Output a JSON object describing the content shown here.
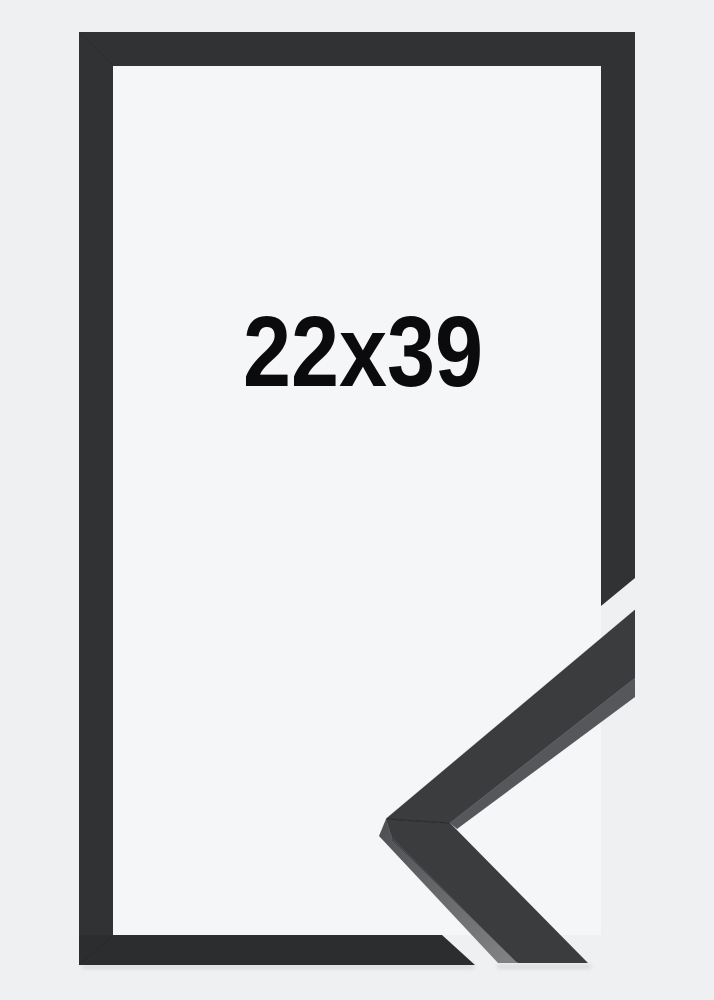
{
  "label": {
    "size": "22x39"
  },
  "colors": {
    "background": "#eff0f2",
    "inner_background": "#f5f6f8",
    "frame": "#303234",
    "frame_bottom": "#2b2d2f",
    "sample_face": "#3a3c3e",
    "sample_inner_edge": "#55575b",
    "sample_side_top": "#4f5154",
    "sample_side_bottom": "#7f8183",
    "seam": "#17181a",
    "shadow": "#a3a5a7",
    "text": "#0b0b0d"
  }
}
